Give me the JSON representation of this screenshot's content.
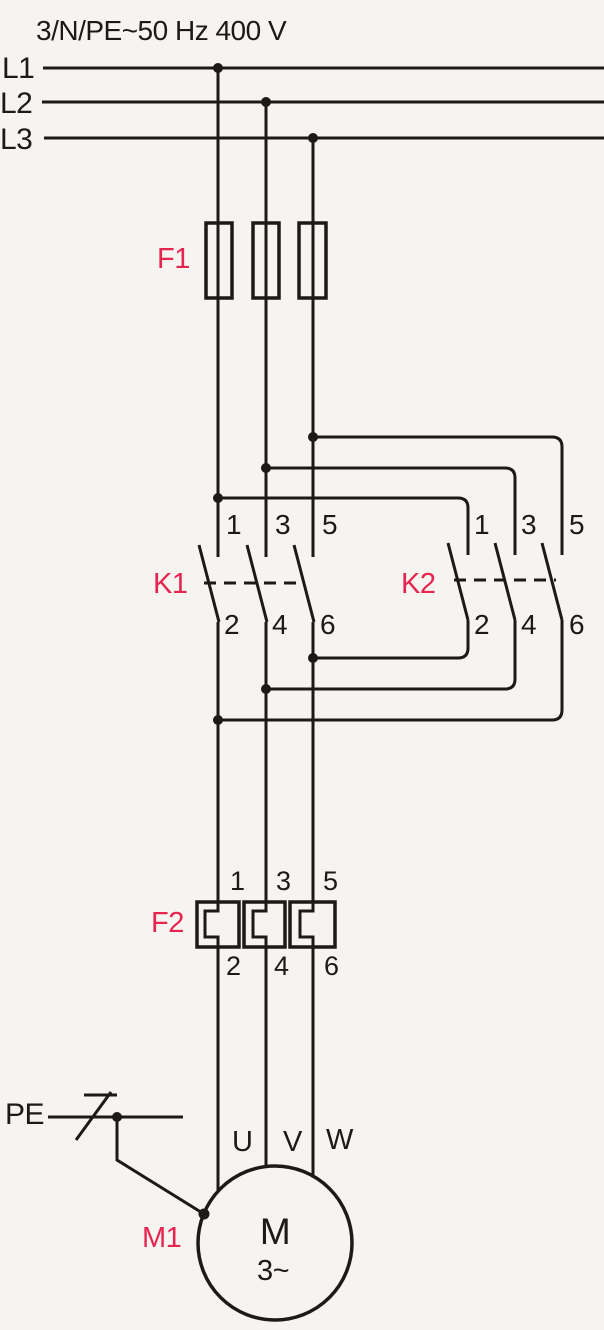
{
  "title": "3/N/PE~50 Hz 400 V",
  "colors": {
    "line": "#1c1916",
    "accent": "#e5254f",
    "background": "#f6f4f0"
  },
  "supply": {
    "lines": [
      "L1",
      "L2",
      "L3"
    ]
  },
  "fuse_f1": {
    "ref": "F1"
  },
  "contactor_k1": {
    "ref": "K1",
    "top_terminals": [
      "1",
      "3",
      "5"
    ],
    "bottom_terminals": [
      "2",
      "4",
      "6"
    ]
  },
  "contactor_k2": {
    "ref": "K2",
    "top_terminals": [
      "1",
      "3",
      "5"
    ],
    "bottom_terminals": [
      "2",
      "4",
      "6"
    ]
  },
  "overload_f2": {
    "ref": "F2",
    "top_terminals": [
      "1",
      "3",
      "5"
    ],
    "bottom_terminals": [
      "2",
      "4",
      "6"
    ]
  },
  "earth": {
    "label": "PE"
  },
  "motor_m1": {
    "ref": "M1",
    "symbol": "M",
    "system": "3~",
    "terminals": [
      "U",
      "V",
      "W"
    ]
  }
}
